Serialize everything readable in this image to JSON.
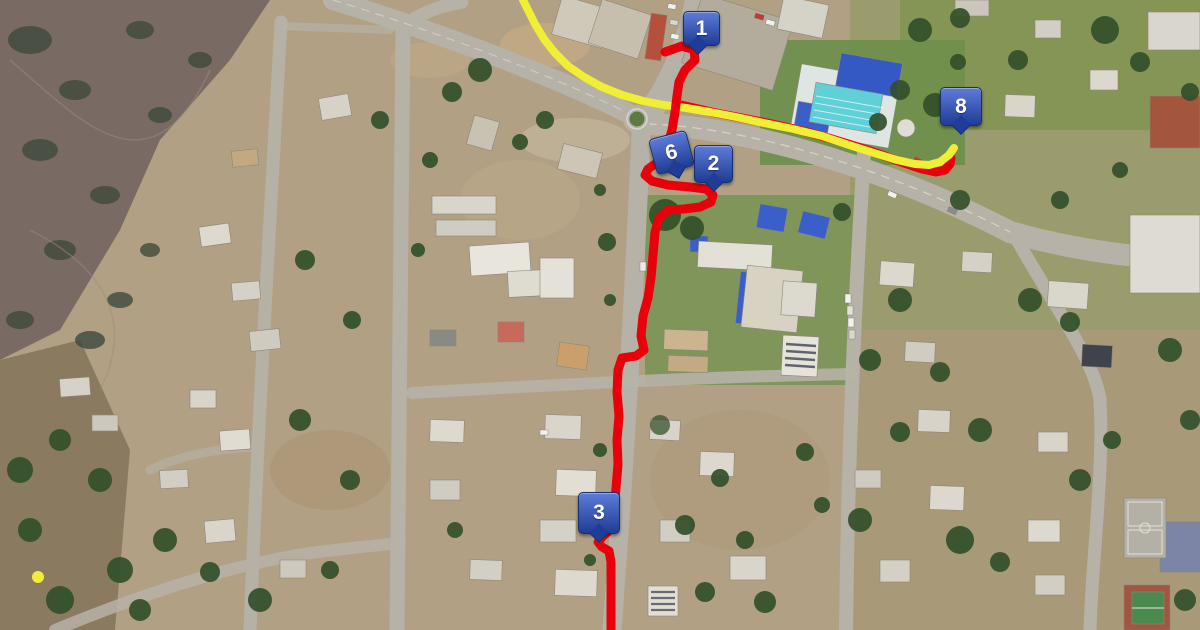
{
  "map": {
    "title": "satellite-route-map",
    "marker_style": {
      "fill_top": "#5d7bd8",
      "fill_bottom": "#1f3d96",
      "border": "#16306e",
      "text_color": "#ffffff"
    },
    "markers": [
      {
        "label": "1",
        "x": 683,
        "y": 11,
        "w": 35,
        "h": 33,
        "rotation": 0,
        "tail": "bottom-left"
      },
      {
        "label": "6",
        "x": 652,
        "y": 134,
        "w": 37,
        "h": 35,
        "rotation": -15,
        "tail": "bottom-center"
      },
      {
        "label": "2",
        "x": 694,
        "y": 145,
        "w": 37,
        "h": 36,
        "rotation": 0,
        "tail": "bottom-center"
      },
      {
        "label": "8",
        "x": 940,
        "y": 87,
        "w": 40,
        "h": 37,
        "rotation": 0,
        "tail": "bottom-center"
      },
      {
        "label": "3",
        "x": 578,
        "y": 492,
        "w": 40,
        "h": 40,
        "rotation": 0,
        "tail": "bottom-center"
      }
    ],
    "routes": [
      {
        "name": "red-route-east",
        "color": "#e8000a",
        "width": 9,
        "points": [
          [
            676,
            104
          ],
          [
            694,
            108
          ],
          [
            716,
            113
          ],
          [
            742,
            118
          ],
          [
            772,
            124
          ],
          [
            803,
            131
          ],
          [
            832,
            139
          ],
          [
            858,
            147
          ],
          [
            882,
            155
          ],
          [
            904,
            163
          ],
          [
            922,
            169
          ],
          [
            936,
            172
          ],
          [
            945,
            170
          ],
          [
            950,
            164
          ],
          [
            951,
            158
          ]
        ]
      },
      {
        "name": "yellow-route",
        "color": "#f0ee35",
        "width": 8,
        "points": [
          [
            523,
            0
          ],
          [
            528,
            10
          ],
          [
            535,
            24
          ],
          [
            544,
            39
          ],
          [
            555,
            53
          ],
          [
            568,
            66
          ],
          [
            584,
            77
          ],
          [
            602,
            87
          ],
          [
            622,
            95
          ],
          [
            643,
            101
          ],
          [
            664,
            105
          ],
          [
            686,
            108
          ],
          [
            710,
            112
          ],
          [
            736,
            117
          ],
          [
            764,
            123
          ],
          [
            793,
            129
          ],
          [
            822,
            136
          ],
          [
            849,
            145
          ],
          [
            874,
            153
          ],
          [
            897,
            160
          ],
          [
            915,
            164
          ],
          [
            929,
            165
          ],
          [
            940,
            162
          ],
          [
            949,
            155
          ],
          [
            954,
            148
          ]
        ]
      },
      {
        "name": "red-route-main",
        "color": "#e8000a",
        "width": 9,
        "points": [
          [
            665,
            52
          ],
          [
            682,
            46
          ],
          [
            694,
            50
          ],
          [
            695,
            60
          ],
          [
            685,
            70
          ],
          [
            679,
            82
          ],
          [
            677,
            96
          ],
          [
            675,
            112
          ],
          [
            672,
            130
          ],
          [
            667,
            148
          ],
          [
            658,
            162
          ],
          [
            648,
            169
          ],
          [
            645,
            175
          ],
          [
            652,
            181
          ],
          [
            668,
            185
          ],
          [
            690,
            187
          ],
          [
            706,
            189
          ],
          [
            713,
            195
          ],
          [
            711,
            202
          ],
          [
            700,
            207
          ],
          [
            684,
            209
          ],
          [
            668,
            210
          ],
          [
            659,
            218
          ],
          [
            655,
            232
          ],
          [
            653,
            255
          ],
          [
            651,
            278
          ],
          [
            648,
            298
          ],
          [
            643,
            316
          ],
          [
            641,
            336
          ],
          [
            644,
            350
          ],
          [
            636,
            356
          ],
          [
            622,
            358
          ],
          [
            618,
            370
          ],
          [
            617,
            392
          ],
          [
            619,
            416
          ],
          [
            617,
            440
          ],
          [
            618,
            464
          ],
          [
            616,
            488
          ],
          [
            614,
            512
          ],
          [
            612,
            528
          ],
          [
            603,
            536
          ],
          [
            598,
            542
          ],
          [
            602,
            547
          ],
          [
            609,
            551
          ],
          [
            611,
            562
          ],
          [
            611,
            590
          ],
          [
            611,
            630
          ]
        ]
      }
    ],
    "dots": [
      {
        "name": "yellow-waypoint-dot",
        "color": "#f0ee35",
        "x": 38,
        "y": 577,
        "r": 6
      }
    ]
  }
}
